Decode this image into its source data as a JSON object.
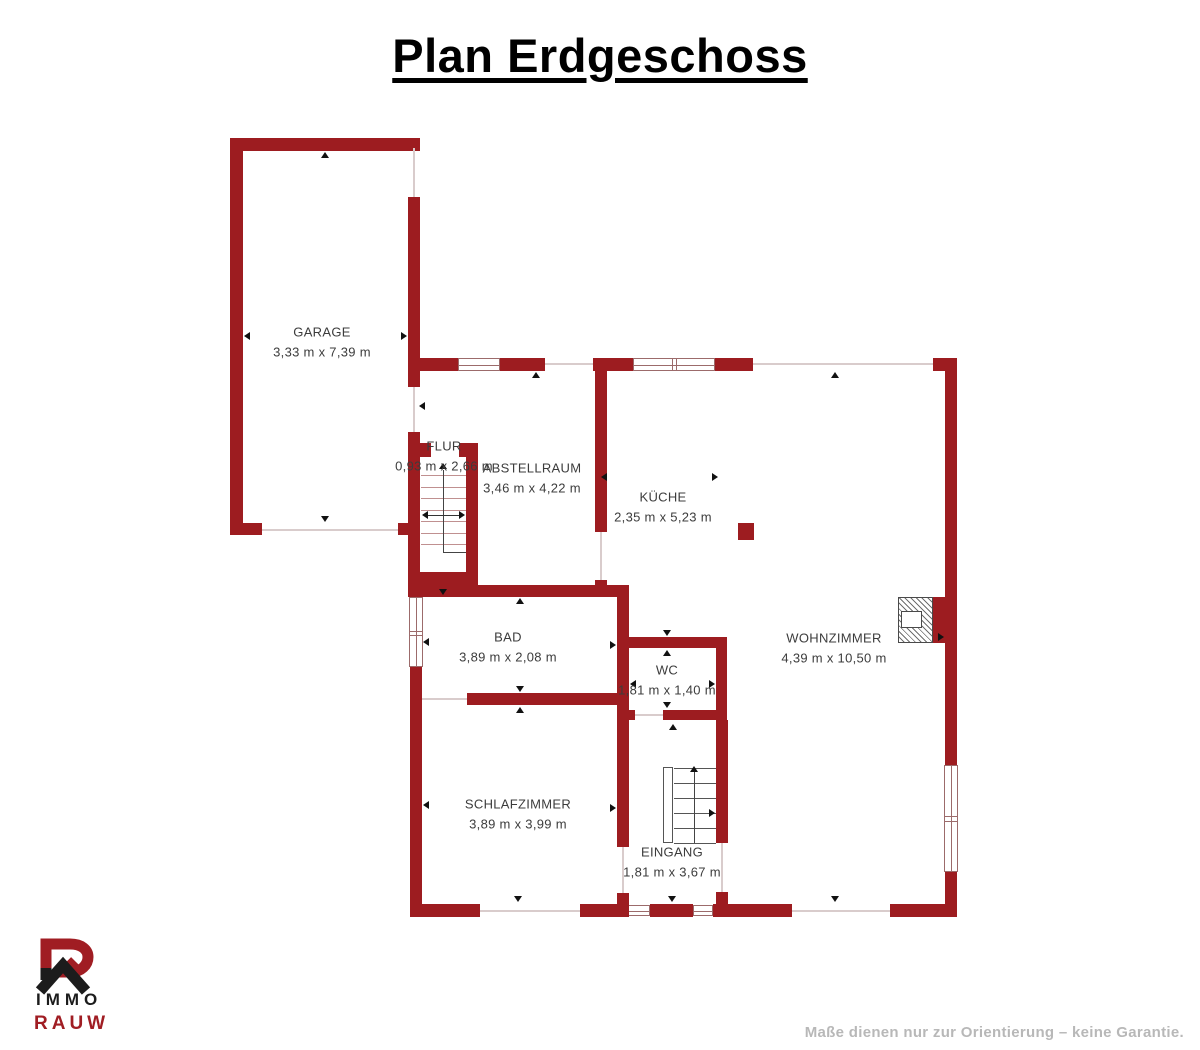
{
  "title": "Plan Erdgeschoss",
  "rooms": {
    "garage": {
      "name": "GARAGE",
      "dims": "3,33 m x 7,39 m"
    },
    "flur": {
      "name": "FLUR",
      "dims": "0,93 m x 2,66 m"
    },
    "abstellraum": {
      "name": "ABSTELLRAUM",
      "dims": "3,46 m x 4,22 m"
    },
    "kueche": {
      "name": "KÜCHE",
      "dims": "2,35 m x 5,23 m"
    },
    "bad": {
      "name": "BAD",
      "dims": "3,89 m x 2,08 m"
    },
    "wc": {
      "name": "WC",
      "dims": "1,81 m x 1,40 m"
    },
    "wohnzimmer": {
      "name": "WOHNZIMMER",
      "dims": "4,39 m x 10,50 m"
    },
    "schlafzimmer": {
      "name": "SCHLAFZIMMER",
      "dims": "3,89 m x 3,99 m"
    },
    "eingang": {
      "name": "EINGANG",
      "dims": "1,81 m x 3,67 m"
    }
  },
  "logo": {
    "top": "IMMO",
    "bottom": "RAUW"
  },
  "footer": {
    "disclaimer": "Maße dienen nur zur Orientierung – keine Garantie."
  },
  "colors": {
    "wall": "#9d1c20",
    "logo_red": "#a01d23",
    "logo_black": "#1c1c1c",
    "label_text": "#3c3c3c",
    "disclaimer_text": "#b8b8b8"
  }
}
